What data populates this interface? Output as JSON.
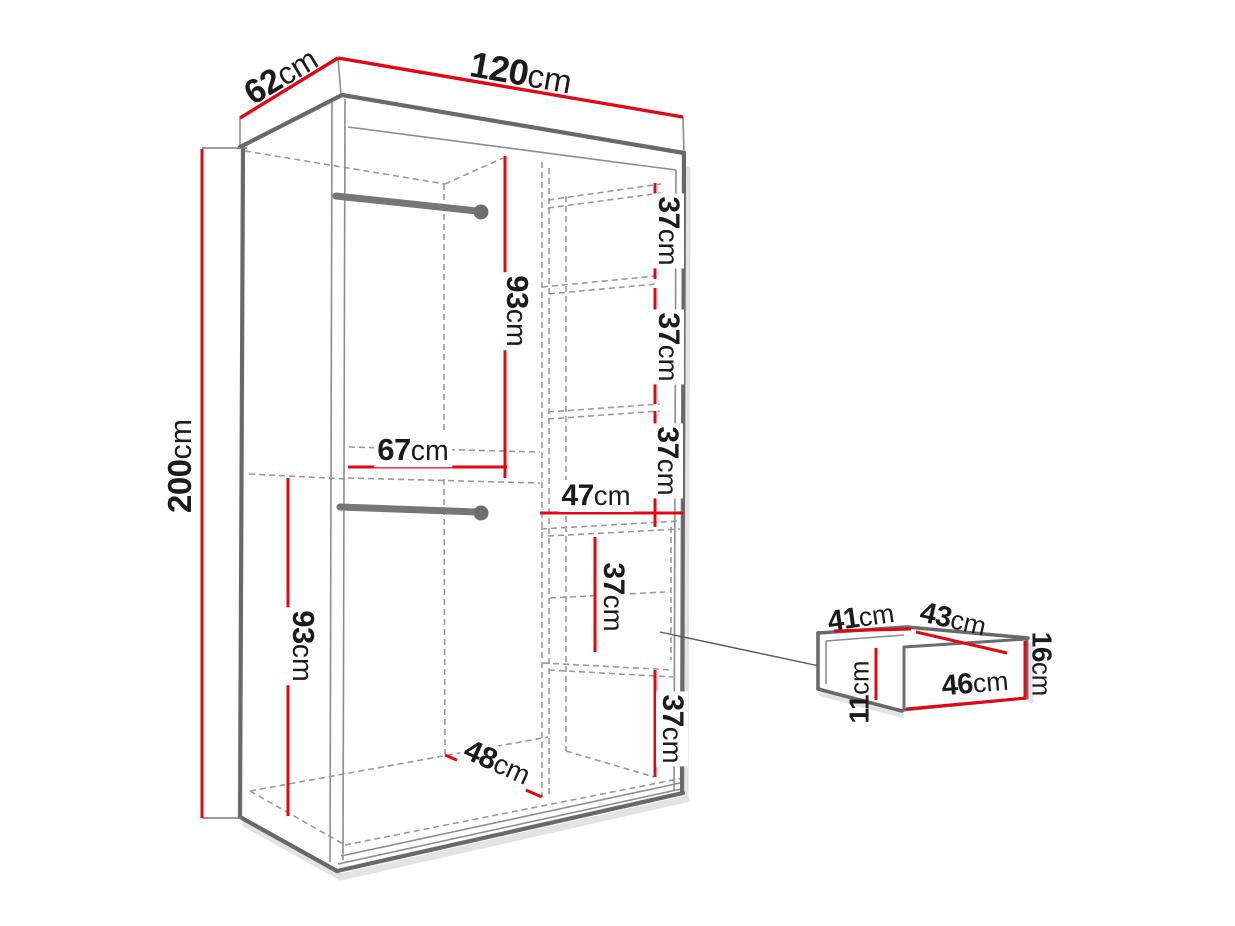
{
  "page": {
    "background": "#ffffff",
    "description": "wardrobe dimension line drawing"
  },
  "colors": {
    "dimension_line": "#e30613",
    "outline": "#696969",
    "hidden_line": "#9a9a9a",
    "label_text": "#1b1b1b",
    "shadow": "#dedede"
  },
  "dimensions": {
    "wardrobe": {
      "depth": {
        "num": "62",
        "unit": "cm"
      },
      "width": {
        "num": "120",
        "unit": "cm"
      },
      "height": {
        "num": "200",
        "unit": "cm"
      }
    },
    "interior_left": {
      "upper_hanging_height": {
        "num": "93",
        "unit": "cm"
      },
      "hanging_width": {
        "num": "67",
        "unit": "cm"
      },
      "lower_hanging_height": {
        "num": "93",
        "unit": "cm"
      },
      "floor_depth": {
        "num": "48",
        "unit": "cm"
      }
    },
    "interior_right": {
      "shelf_gap_top": {
        "num": "37",
        "unit": "cm"
      },
      "shelf_gap_middle": {
        "num": "37",
        "unit": "cm"
      },
      "shelf_gap_lower": {
        "num": "37",
        "unit": "cm"
      },
      "shelf_width": {
        "num": "47",
        "unit": "cm"
      },
      "drawer_bay_height": {
        "num": "37",
        "unit": "cm"
      },
      "bottom_gap": {
        "num": "37",
        "unit": "cm"
      }
    },
    "drawer": {
      "inner_depth": {
        "num": "41",
        "unit": "cm"
      },
      "inner_width": {
        "num": "43",
        "unit": "cm"
      },
      "front_height": {
        "num": "16",
        "unit": "cm"
      },
      "inner_height": {
        "num": "11",
        "unit": "cm"
      },
      "front_width": {
        "num": "46",
        "unit": "cm"
      }
    }
  }
}
